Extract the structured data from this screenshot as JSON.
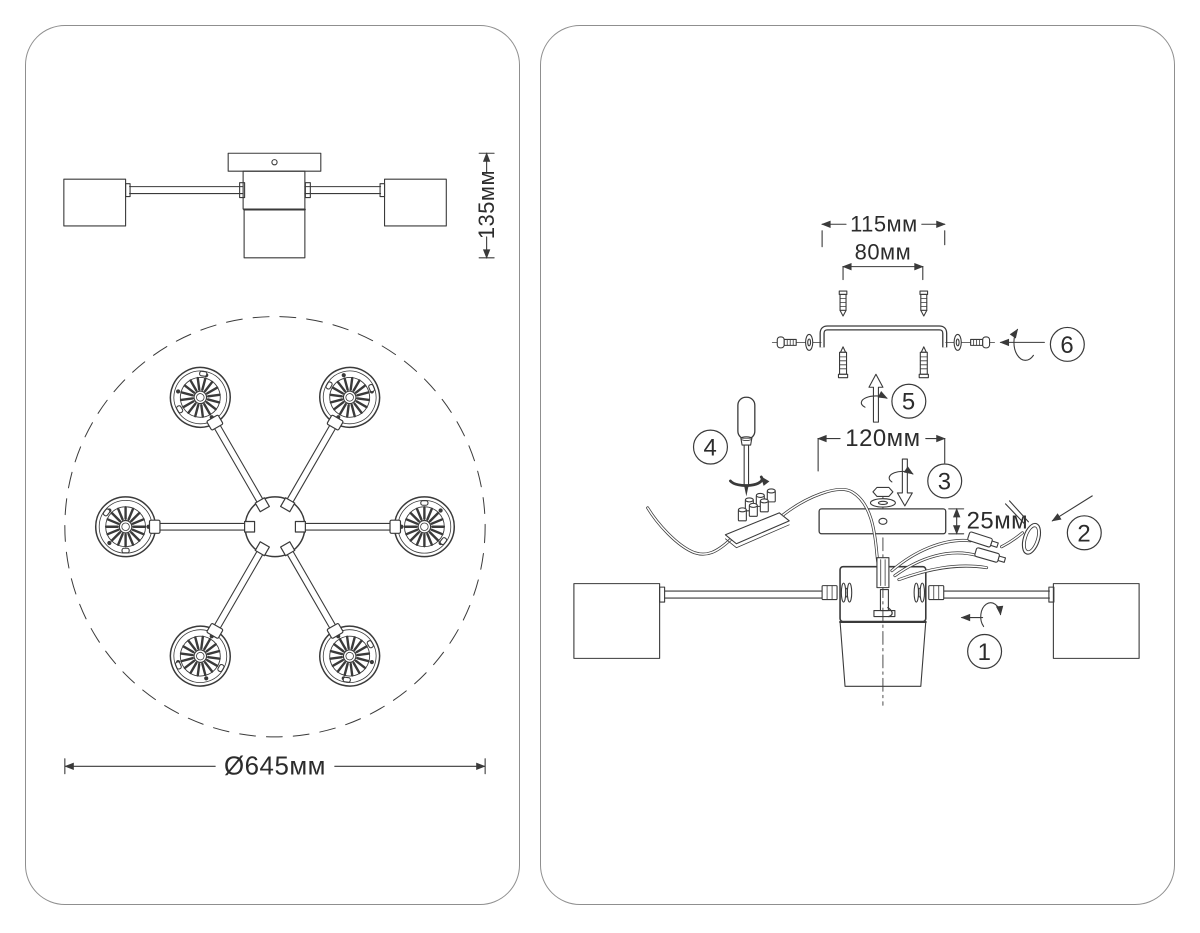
{
  "sheet": {
    "background": "#ffffff",
    "panel_border": "#8f8f8f",
    "line_color": "#3a3a3a",
    "text_color": "#2c2c2c"
  },
  "left_panel": {
    "side_view": {
      "height_dim": "135мм"
    },
    "top_view": {
      "diameter_dim": "Ø645мм",
      "lamp_count": 6
    }
  },
  "right_panel": {
    "dims": {
      "bracket_length": "115мм",
      "screw_spacing": "80мм",
      "canopy_width": "120мм",
      "canopy_height": "25мм"
    },
    "steps": [
      {
        "num": "1"
      },
      {
        "num": "2"
      },
      {
        "num": "3"
      },
      {
        "num": "4"
      },
      {
        "num": "5"
      },
      {
        "num": "6"
      }
    ]
  }
}
